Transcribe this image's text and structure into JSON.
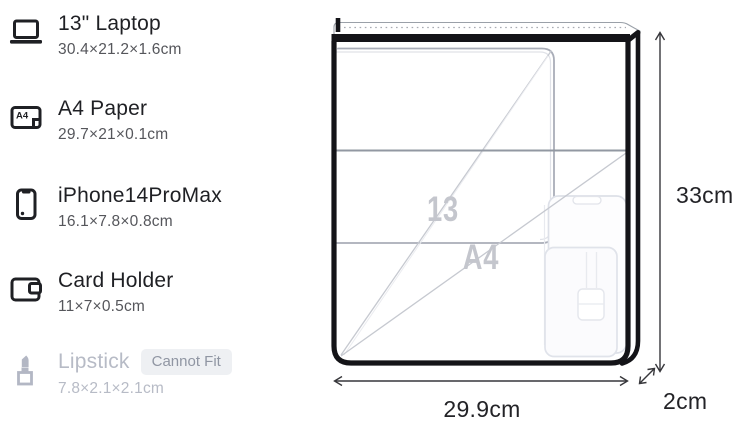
{
  "items": [
    {
      "icon": "laptop-icon",
      "name": "13\" Laptop",
      "dims": "30.4×21.2×1.6cm",
      "fits": true
    },
    {
      "icon": "a4-paper-icon",
      "name": "A4 Paper",
      "dims": "29.7×21×0.1cm",
      "fits": true
    },
    {
      "icon": "phone-icon",
      "name": "iPhone14ProMax",
      "dims": "16.1×7.8×0.8cm",
      "fits": true
    },
    {
      "icon": "card-holder-icon",
      "name": "Card Holder",
      "dims": "11×7×0.5cm",
      "fits": true
    },
    {
      "icon": "lipstick-icon",
      "name": "Lipstick",
      "dims": "7.8×2.1×2.1cm",
      "fits": false,
      "badge": "Cannot Fit"
    }
  ],
  "diagram": {
    "height_label": "33cm",
    "width_label": "29.9cm",
    "depth_label": "2cm",
    "ghost_laptop_label": "13",
    "ghost_paper_label": "A4"
  },
  "colors": {
    "text_primary": "#1f2024",
    "text_secondary": "#55565b",
    "disabled_text": "#b7bbc6",
    "badge_bg": "#eef0f3",
    "badge_text": "#9096a3",
    "bag_outline": "#141418",
    "ghost_outline": "#b0b4be",
    "ghost_label": "#c4c6cd"
  }
}
